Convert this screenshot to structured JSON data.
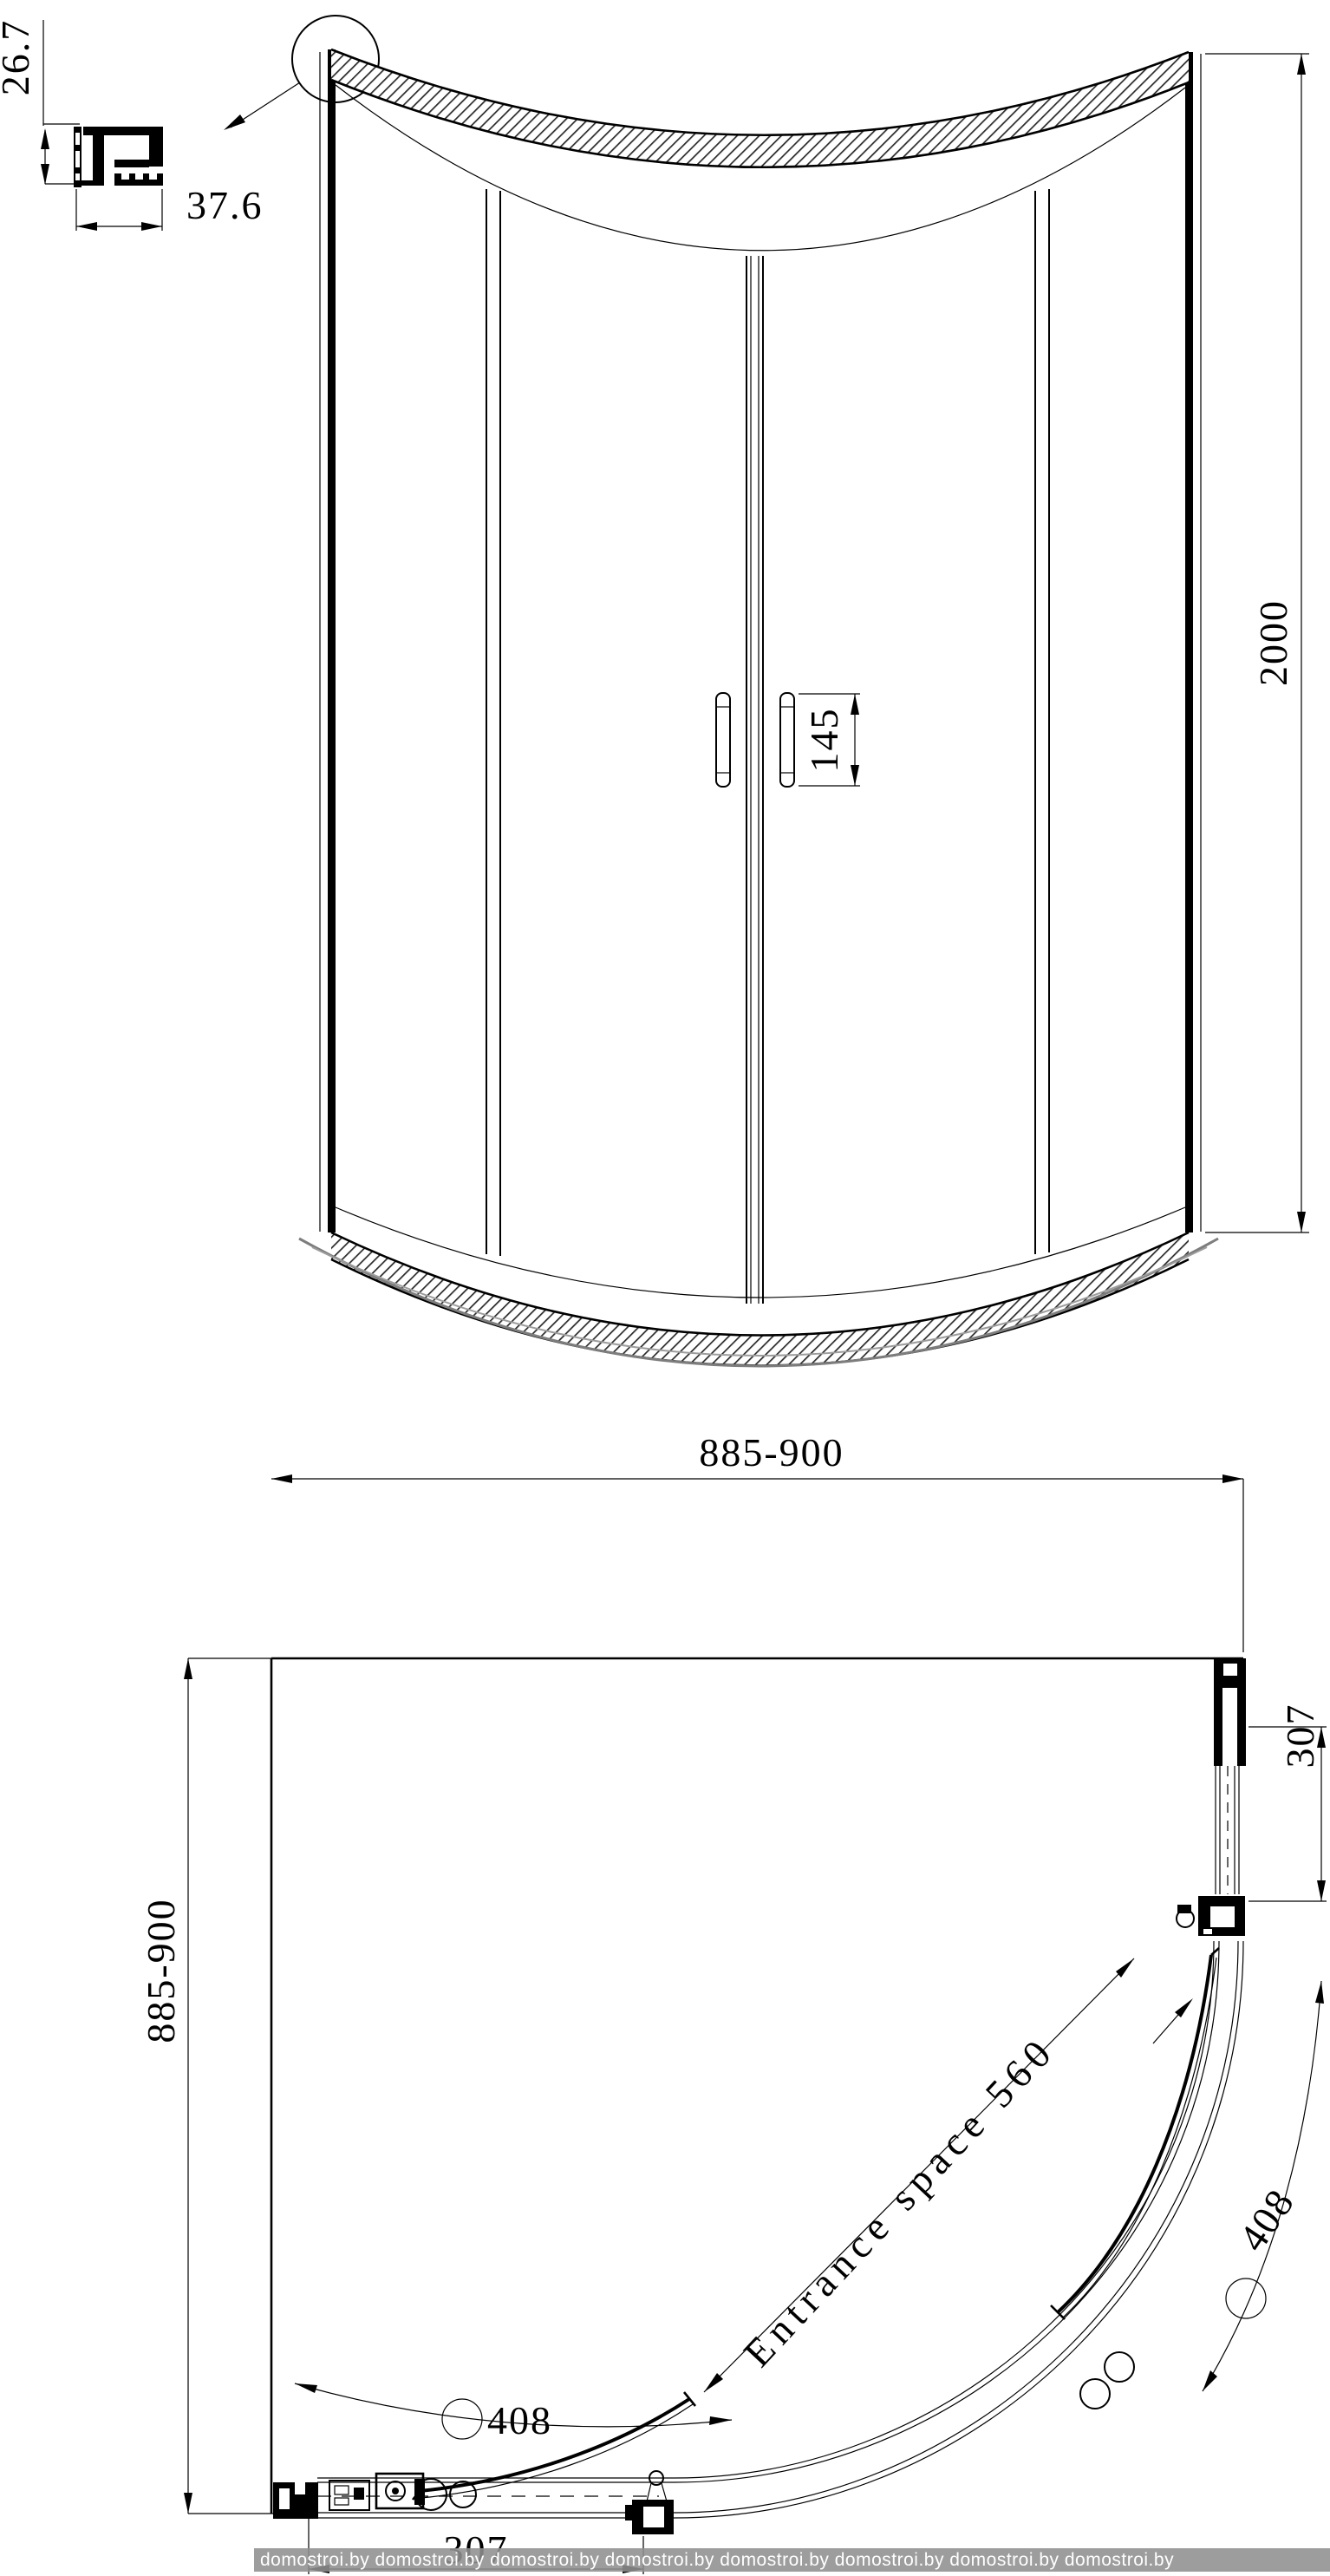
{
  "drawing": {
    "profile_detail": {
      "height": "26.7",
      "width": "37.6"
    },
    "front_view": {
      "overall_height": "2000",
      "handle_length": "145"
    },
    "plan_view": {
      "overall_width": "885-900",
      "overall_depth": "885-900",
      "side_panel_right": "307",
      "side_panel_bottom": "307",
      "door_arc_right": "408",
      "door_arc_left": "408",
      "entrance_label": "Entrance space 560"
    },
    "watermark": {
      "band_color": "#8f8f8f",
      "band_text": "domostroi.by  domostroi.by  domostroi.by  domostroi.by  domostroi.by  domostroi.by  domostroi.by  domostroi.by"
    }
  }
}
